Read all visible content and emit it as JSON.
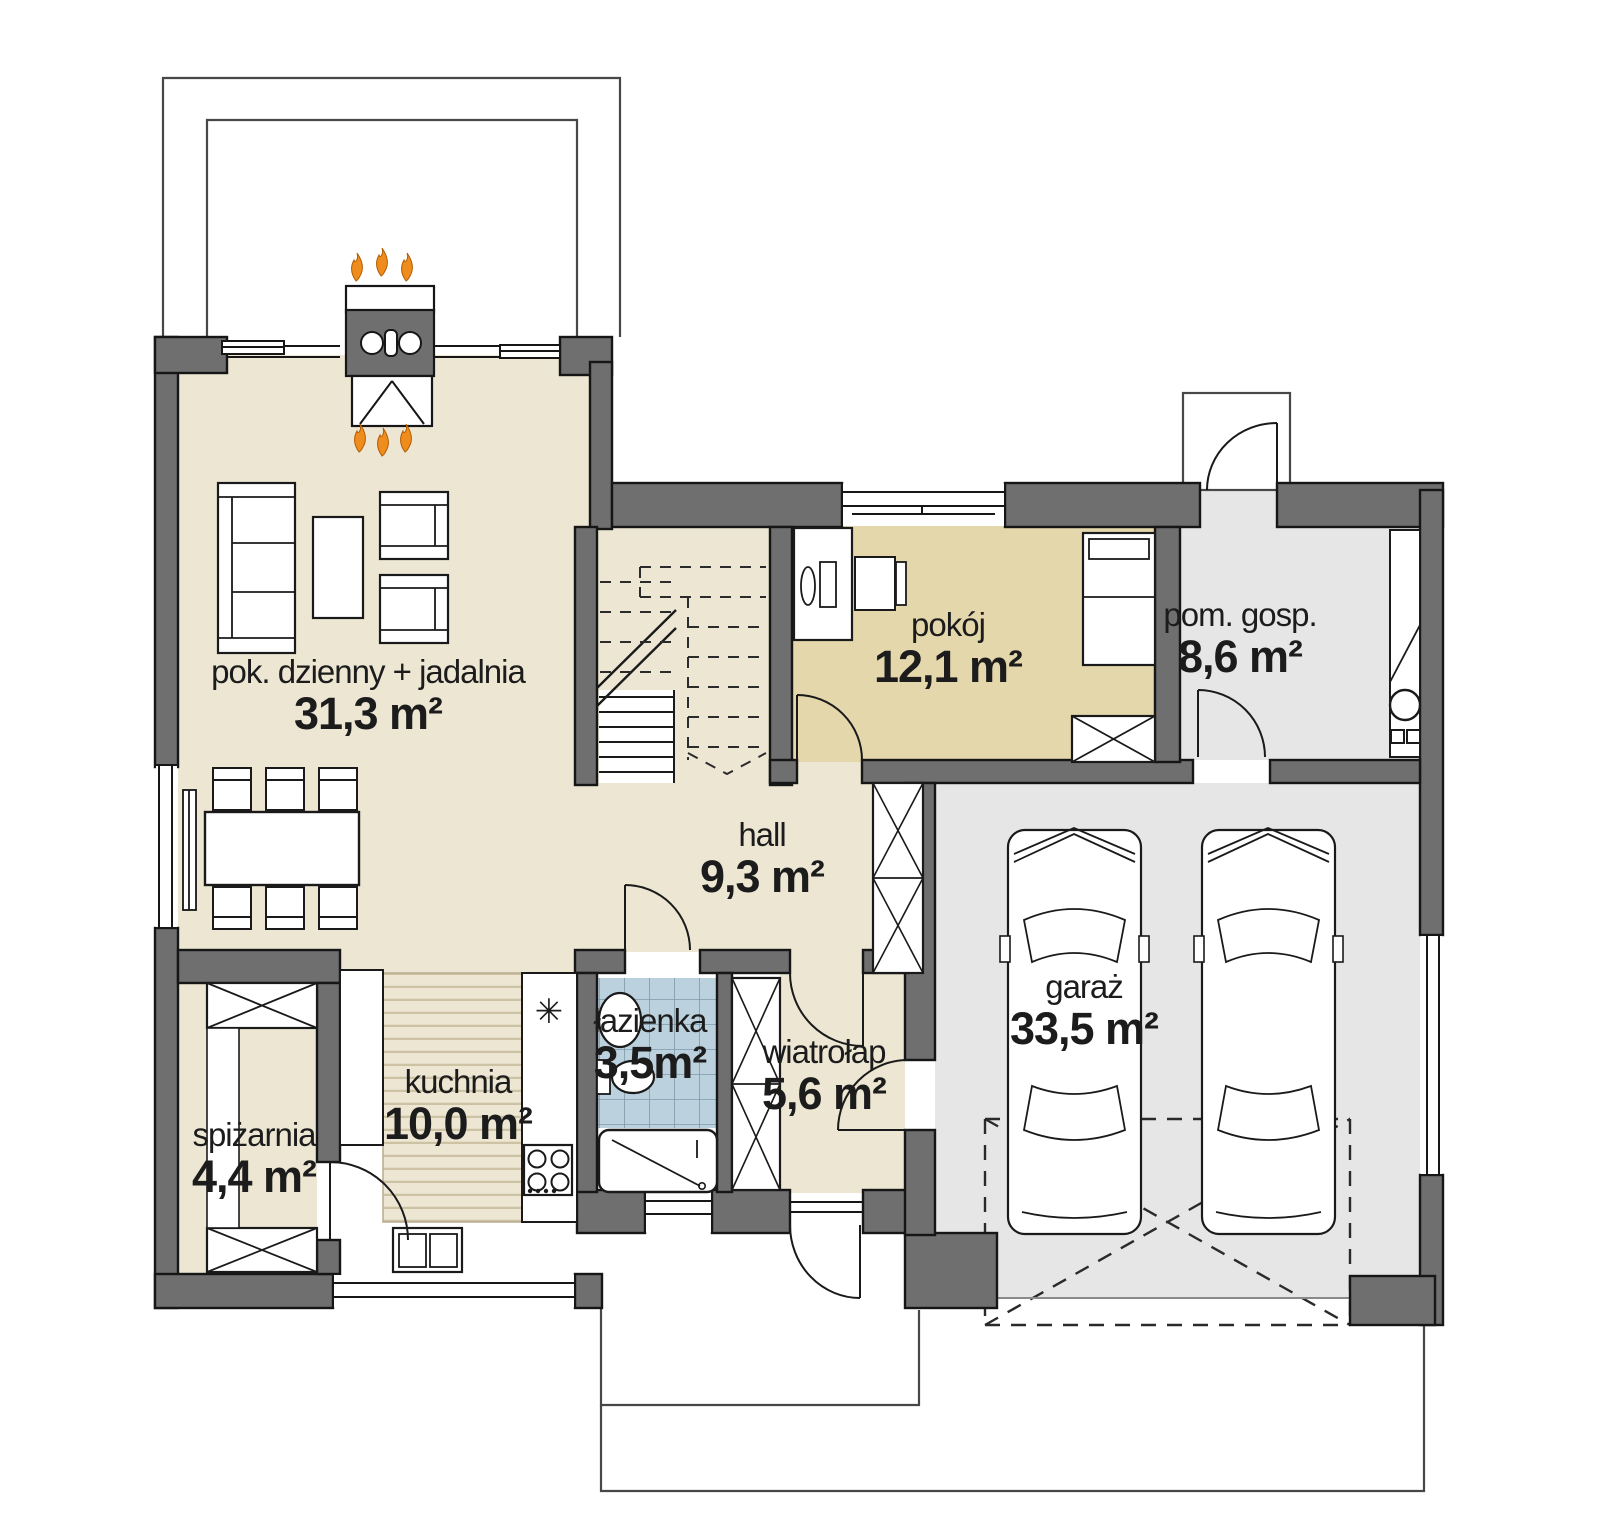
{
  "plan": {
    "type": "architectural-floor-plan",
    "language": "pl",
    "rooms": [
      {
        "id": "living",
        "name": "pok. dzienny + jadalnia",
        "area": "31,3 m²"
      },
      {
        "id": "pokoj",
        "name": "pokój",
        "area": "12,1 m²"
      },
      {
        "id": "pom_gosp",
        "name": "pom. gosp.",
        "area": "8,6 m²"
      },
      {
        "id": "hall",
        "name": "hall",
        "area": "9,3 m²"
      },
      {
        "id": "garaz",
        "name": "garaż",
        "area": "33,5 m²"
      },
      {
        "id": "kuchnia",
        "name": "kuchnia",
        "area": "10,0 m²"
      },
      {
        "id": "lazienka",
        "name": "łazienka",
        "area": "3,5m²"
      },
      {
        "id": "wiatrolap",
        "name": "wiatrołap",
        "area": "5,6 m²"
      },
      {
        "id": "spizarnia",
        "name": "spiżarnia",
        "area": "4,4 m²"
      }
    ],
    "symbols": {
      "kitchen_appliance_marker": "✳"
    },
    "colors": {
      "wall": "#6f6f6f",
      "outline": "#1a1a1a",
      "floor_main": "#ece6d3",
      "floor_room": "#e4d7ac",
      "floor_utility": "#e6e6e6",
      "floor_bath_tile": "#bcd1de",
      "tile_grid": "#7e99a9",
      "kitchen_stripe": "#cdc3a4",
      "flame": "#ef8c1e"
    }
  }
}
